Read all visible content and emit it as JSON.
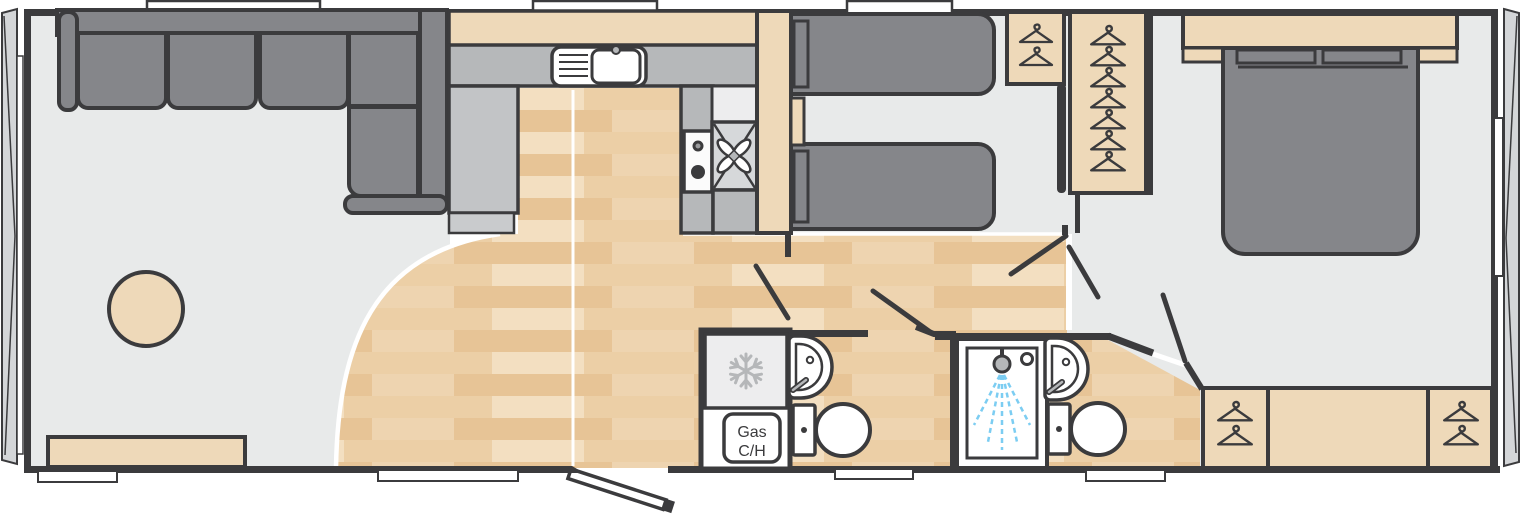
{
  "plan": {
    "gas_heater_label": {
      "line1": "Gas",
      "line2": "C/H"
    },
    "wardrobe_hanger_counts": {
      "twin_small": 2,
      "twin_tall": 7,
      "master_left": 2,
      "master_right": 2
    },
    "colors": {
      "wall": "#3b3b3d",
      "carpet": "#e8eaea",
      "wood_base": "#eccfa6",
      "wood_stripe": "#e7c496",
      "wood_light": "#f3dfc1",
      "furniture_tan": "#eed9b9",
      "table_tan": "#ecdcc0",
      "chair_tan": "#f2e4ca",
      "unit_gray": "#b6b8ba",
      "unit_gray2": "#c2c4c6",
      "upholstery_gray": "#85868a",
      "fridge_gray": "#ededee",
      "oven_gray": "#d6d8da",
      "snowflake_gray": "#b5b7b9",
      "spray_blue": "#7ccdf2",
      "glazing_gray": "#d4d6d8"
    }
  }
}
